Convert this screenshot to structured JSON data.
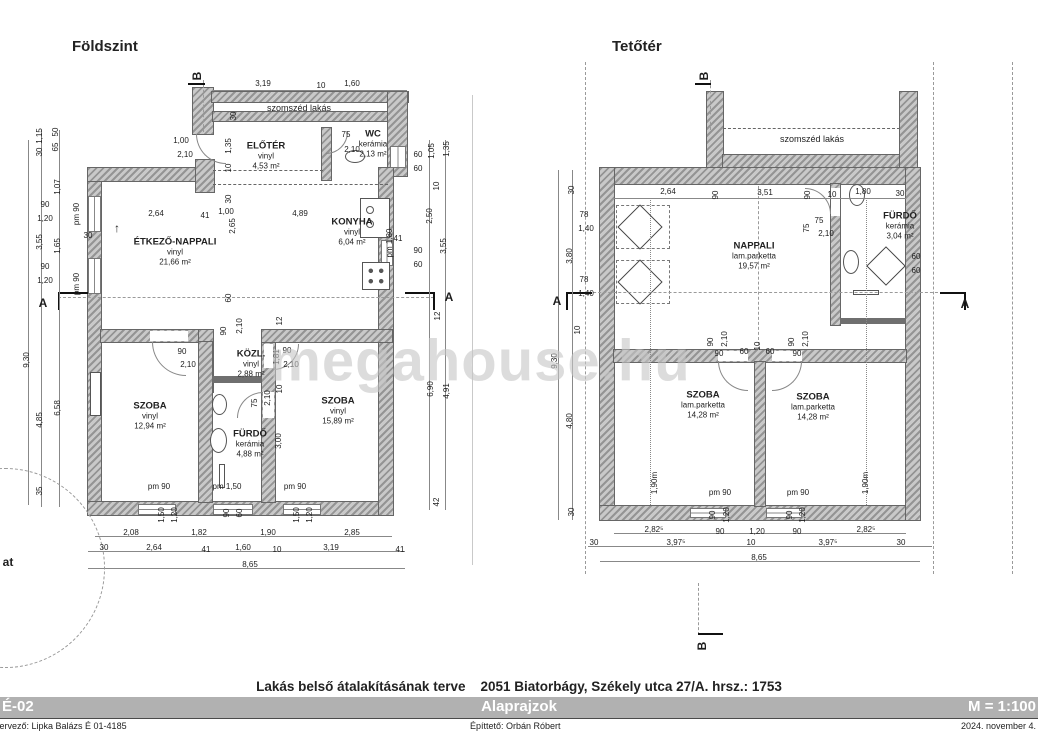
{
  "watermark": "megahouse.hu",
  "footer": {
    "project_title": "Lakás belső átalakításának terve",
    "address": "2051 Biatorbágy, Székely utca 27/A. hrsz.: 1753",
    "sheet_code": "É-02",
    "sheet_name": "Alaprajzok",
    "scale": "M = 1:100",
    "designer": "tervező: Lipka  Balázs É 01-4185",
    "client": "Építtető: Orbán Róbert",
    "date": "2024. november 4."
  },
  "ground": {
    "title": "Földszint",
    "neighbor": "szomszéd lakás",
    "rooms": [
      {
        "n": "ELŐTÉR",
        "f": "vinyl",
        "a": "4,53 m²",
        "x": 266,
        "y": 156
      },
      {
        "n": "WC",
        "f": "kerámia",
        "a": "2,13 m²",
        "x": 373,
        "y": 144
      },
      {
        "n": "KONYHA",
        "f": "vinyl",
        "a": "6,04 m²",
        "x": 352,
        "y": 232
      },
      {
        "n": "ÉTKEZŐ-NAPPALI",
        "f": "vinyl",
        "a": "21,66 m²",
        "x": 175,
        "y": 252
      },
      {
        "n": "KÖZL.",
        "f": "vinyl",
        "a": "2,88 m²",
        "x": 251,
        "y": 364
      },
      {
        "n": "SZOBA",
        "f": "vinyl",
        "a": "12,94 m²",
        "x": 150,
        "y": 416
      },
      {
        "n": "FÜRDŐ",
        "f": "kerámia",
        "a": "4,88 m²",
        "x": 250,
        "y": 444
      },
      {
        "n": "SZOBA",
        "f": "vinyl",
        "a": "15,89 m²",
        "x": 338,
        "y": 411
      }
    ],
    "dims": [
      {
        "t": "B",
        "x": 197,
        "y": 76,
        "r": -90,
        "b": 1
      },
      {
        "t": "3,19",
        "x": 263,
        "y": 84
      },
      {
        "t": "10",
        "x": 321,
        "y": 86
      },
      {
        "t": "1,60",
        "x": 352,
        "y": 84
      },
      {
        "t": "30",
        "x": 234,
        "y": 116,
        "r": -90
      },
      {
        "t": "1,00",
        "x": 181,
        "y": 141
      },
      {
        "t": "2,10",
        "x": 185,
        "y": 155
      },
      {
        "t": "1,35",
        "x": 229,
        "y": 146,
        "r": -90
      },
      {
        "t": "10",
        "x": 229,
        "y": 168,
        "r": -90
      },
      {
        "t": "75",
        "x": 346,
        "y": 135
      },
      {
        "t": "2,10",
        "x": 352,
        "y": 150
      },
      {
        "t": "pm 1,80",
        "x": 390,
        "y": 243,
        "r": -90
      },
      {
        "t": "60",
        "x": 418,
        "y": 155
      },
      {
        "t": "60",
        "x": 418,
        "y": 169
      },
      {
        "t": "1,05",
        "x": 432,
        "y": 151,
        "r": -90
      },
      {
        "t": "1,35",
        "x": 447,
        "y": 149,
        "r": -90
      },
      {
        "t": "10",
        "x": 437,
        "y": 186,
        "r": -90
      },
      {
        "t": "2,50",
        "x": 430,
        "y": 216,
        "r": -90
      },
      {
        "t": "90",
        "x": 418,
        "y": 251
      },
      {
        "t": "60",
        "x": 418,
        "y": 265
      },
      {
        "t": "3,55",
        "x": 444,
        "y": 246,
        "r": -90
      },
      {
        "t": "41",
        "x": 398,
        "y": 239
      },
      {
        "t": "A",
        "x": 449,
        "y": 297,
        "b": 1
      },
      {
        "t": "12",
        "x": 438,
        "y": 316,
        "r": -90
      },
      {
        "t": "6,90",
        "x": 431,
        "y": 389,
        "r": -90
      },
      {
        "t": "4,91",
        "x": 447,
        "y": 391,
        "r": -90
      },
      {
        "t": "42",
        "x": 437,
        "y": 502,
        "r": -90
      },
      {
        "t": "1,15",
        "x": 40,
        "y": 136,
        "r": -90
      },
      {
        "t": "30",
        "x": 40,
        "y": 152,
        "r": -90
      },
      {
        "t": "50",
        "x": 56,
        "y": 132,
        "r": -90
      },
      {
        "t": "65",
        "x": 56,
        "y": 147,
        "r": -90
      },
      {
        "t": "1,07",
        "x": 58,
        "y": 187,
        "r": -90
      },
      {
        "t": "90",
        "x": 45,
        "y": 205
      },
      {
        "t": "1,20",
        "x": 45,
        "y": 219
      },
      {
        "t": "pm 90",
        "x": 77,
        "y": 214,
        "r": -90
      },
      {
        "t": "3,55",
        "x": 40,
        "y": 242,
        "r": -90
      },
      {
        "t": "1,65",
        "x": 58,
        "y": 246,
        "r": -90
      },
      {
        "t": "30",
        "x": 88,
        "y": 236
      },
      {
        "t": "90",
        "x": 45,
        "y": 267
      },
      {
        "t": "1,20",
        "x": 45,
        "y": 281
      },
      {
        "t": "pm 90",
        "x": 77,
        "y": 284,
        "r": -90
      },
      {
        "t": "A",
        "x": 43,
        "y": 303,
        "b": 1
      },
      {
        "t": "9,30",
        "x": 27,
        "y": 360,
        "r": -90
      },
      {
        "t": "4,85",
        "x": 40,
        "y": 420,
        "r": -90
      },
      {
        "t": "6,58",
        "x": 58,
        "y": 408,
        "r": -90
      },
      {
        "t": "35",
        "x": 40,
        "y": 491,
        "r": -90
      },
      {
        "t": "↑",
        "x": 117,
        "y": 228,
        "b": 1
      },
      {
        "t": "30",
        "x": 229,
        "y": 199,
        "r": -90
      },
      {
        "t": "1,00",
        "x": 226,
        "y": 212
      },
      {
        "t": "2,64",
        "x": 156,
        "y": 214
      },
      {
        "t": "41",
        "x": 205,
        "y": 216
      },
      {
        "t": "4,89",
        "x": 300,
        "y": 214
      },
      {
        "t": "2,65",
        "x": 233,
        "y": 226,
        "r": -90
      },
      {
        "t": "60",
        "x": 229,
        "y": 298,
        "r": -90
      },
      {
        "t": "90",
        "x": 224,
        "y": 331,
        "r": -90
      },
      {
        "t": "2,10",
        "x": 240,
        "y": 326,
        "r": -90
      },
      {
        "t": "90",
        "x": 182,
        "y": 352
      },
      {
        "t": "2,10",
        "x": 188,
        "y": 365
      },
      {
        "t": "90",
        "x": 287,
        "y": 351
      },
      {
        "t": "1,81",
        "x": 277,
        "y": 357,
        "r": -90
      },
      {
        "t": "2,10",
        "x": 291,
        "y": 365
      },
      {
        "t": "12",
        "x": 280,
        "y": 321,
        "r": -90
      },
      {
        "t": "75",
        "x": 255,
        "y": 403,
        "r": -90
      },
      {
        "t": "2,10",
        "x": 268,
        "y": 398,
        "r": -90
      },
      {
        "t": "10",
        "x": 280,
        "y": 389,
        "r": -90
      },
      {
        "t": "3,00",
        "x": 279,
        "y": 441,
        "r": -90
      },
      {
        "t": "pm 90",
        "x": 159,
        "y": 487
      },
      {
        "t": "pm 1,50",
        "x": 227,
        "y": 487
      },
      {
        "t": "pm 90",
        "x": 295,
        "y": 487
      },
      {
        "t": "1,50",
        "x": 162,
        "y": 515,
        "r": -90
      },
      {
        "t": "1,20",
        "x": 175,
        "y": 515,
        "r": -90
      },
      {
        "t": "90",
        "x": 227,
        "y": 513,
        "r": -90
      },
      {
        "t": "60",
        "x": 240,
        "y": 513,
        "r": -90
      },
      {
        "t": "1,50",
        "x": 297,
        "y": 515,
        "r": -90
      },
      {
        "t": "1,20",
        "x": 310,
        "y": 515,
        "r": -90
      },
      {
        "t": "2,08",
        "x": 131,
        "y": 533
      },
      {
        "t": "1,82",
        "x": 199,
        "y": 533
      },
      {
        "t": "1,90",
        "x": 268,
        "y": 533
      },
      {
        "t": "2,85",
        "x": 352,
        "y": 533
      },
      {
        "t": "30",
        "x": 104,
        "y": 548
      },
      {
        "t": "2,64",
        "x": 154,
        "y": 548
      },
      {
        "t": "41",
        "x": 206,
        "y": 550
      },
      {
        "t": "1,60",
        "x": 243,
        "y": 548
      },
      {
        "t": "10",
        "x": 277,
        "y": 550
      },
      {
        "t": "3,19",
        "x": 331,
        "y": 548
      },
      {
        "t": "41",
        "x": 400,
        "y": 550
      },
      {
        "t": "8,65",
        "x": 250,
        "y": 565
      },
      {
        "t": "at",
        "x": 8,
        "y": 562,
        "b": 1
      }
    ]
  },
  "attic": {
    "title": "Tetőtér",
    "neighbor": "szomszéd lakás",
    "rooms": [
      {
        "n": "NAPPALI",
        "f": "lam.parketta",
        "a": "19,57 m²",
        "x": 754,
        "y": 256
      },
      {
        "n": "FÜRDŐ",
        "f": "kerámia",
        "a": "3,04 m²",
        "x": 900,
        "y": 226
      },
      {
        "n": "SZOBA",
        "f": "lam.parketta",
        "a": "14,28 m²",
        "x": 703,
        "y": 405
      },
      {
        "n": "SZOBA",
        "f": "lam.parketta",
        "a": "14,28 m²",
        "x": 813,
        "y": 407
      }
    ],
    "dims": [
      {
        "t": "B",
        "x": 704,
        "y": 76,
        "r": -90,
        "b": 1
      },
      {
        "t": "B",
        "x": 702,
        "y": 646,
        "r": -90,
        "b": 1
      },
      {
        "t": "2,64",
        "x": 668,
        "y": 192
      },
      {
        "t": "90",
        "x": 716,
        "y": 195,
        "r": -90
      },
      {
        "t": "3,51",
        "x": 765,
        "y": 193
      },
      {
        "t": "90",
        "x": 808,
        "y": 195,
        "r": -90
      },
      {
        "t": "10",
        "x": 832,
        "y": 195
      },
      {
        "t": "1,80",
        "x": 863,
        "y": 192
      },
      {
        "t": "30",
        "x": 900,
        "y": 194
      },
      {
        "t": "75",
        "x": 819,
        "y": 221
      },
      {
        "t": "2,10",
        "x": 826,
        "y": 234
      },
      {
        "t": "75",
        "x": 807,
        "y": 228,
        "r": -90
      },
      {
        "t": "30",
        "x": 572,
        "y": 190,
        "r": -90
      },
      {
        "t": "78",
        "x": 584,
        "y": 215
      },
      {
        "t": "1,40",
        "x": 586,
        "y": 229
      },
      {
        "t": "3,80",
        "x": 570,
        "y": 256,
        "r": -90
      },
      {
        "t": "78",
        "x": 584,
        "y": 280
      },
      {
        "t": "1,40",
        "x": 586,
        "y": 294
      },
      {
        "t": "A",
        "x": 557,
        "y": 301,
        "b": 1
      },
      {
        "t": "10",
        "x": 578,
        "y": 330,
        "r": -90
      },
      {
        "t": "9,30",
        "x": 555,
        "y": 361,
        "r": -90
      },
      {
        "t": "4,80",
        "x": 570,
        "y": 421,
        "r": -90
      },
      {
        "t": "30",
        "x": 572,
        "y": 512,
        "r": -90
      },
      {
        "t": "60",
        "x": 916,
        "y": 257
      },
      {
        "t": "60",
        "x": 916,
        "y": 271
      },
      {
        "t": "A",
        "x": 965,
        "y": 304,
        "b": 1
      },
      {
        "t": "90",
        "x": 711,
        "y": 342,
        "r": -90
      },
      {
        "t": "2,10",
        "x": 725,
        "y": 339,
        "r": -90
      },
      {
        "t": "90",
        "x": 719,
        "y": 354
      },
      {
        "t": "60",
        "x": 744,
        "y": 352
      },
      {
        "t": "10",
        "x": 758,
        "y": 346,
        "r": -90
      },
      {
        "t": "60",
        "x": 770,
        "y": 352
      },
      {
        "t": "90",
        "x": 797,
        "y": 354
      },
      {
        "t": "90",
        "x": 792,
        "y": 342,
        "r": -90
      },
      {
        "t": "2,10",
        "x": 806,
        "y": 339,
        "r": -90
      },
      {
        "t": "1,90m",
        "x": 655,
        "y": 483,
        "r": -90
      },
      {
        "t": "1,90m",
        "x": 866,
        "y": 483,
        "r": -90
      },
      {
        "t": "pm 90",
        "x": 720,
        "y": 493
      },
      {
        "t": "pm 90",
        "x": 798,
        "y": 493
      },
      {
        "t": "90",
        "x": 713,
        "y": 515,
        "r": -90
      },
      {
        "t": "1,20",
        "x": 727,
        "y": 515,
        "r": -90
      },
      {
        "t": "90",
        "x": 790,
        "y": 515,
        "r": -90
      },
      {
        "t": "1,20",
        "x": 803,
        "y": 515,
        "r": -90
      },
      {
        "t": "2,82⁵",
        "x": 654,
        "y": 530
      },
      {
        "t": "90",
        "x": 720,
        "y": 532
      },
      {
        "t": "1,20",
        "x": 757,
        "y": 532
      },
      {
        "t": "90",
        "x": 797,
        "y": 532
      },
      {
        "t": "2,82⁵",
        "x": 866,
        "y": 530
      },
      {
        "t": "30",
        "x": 594,
        "y": 543
      },
      {
        "t": "3,97⁵",
        "x": 676,
        "y": 543
      },
      {
        "t": "10",
        "x": 751,
        "y": 543
      },
      {
        "t": "3,97⁵",
        "x": 828,
        "y": 543
      },
      {
        "t": "30",
        "x": 901,
        "y": 543
      },
      {
        "t": "8,65",
        "x": 759,
        "y": 558
      }
    ]
  }
}
